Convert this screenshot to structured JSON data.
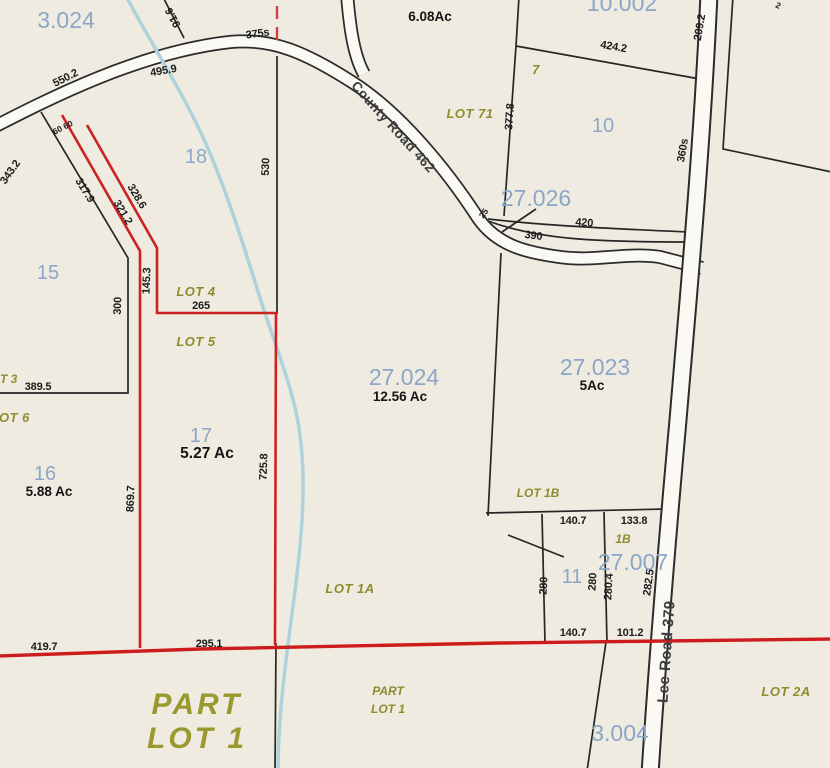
{
  "map_type": "parcel-plat-map",
  "colors": {
    "background": "#efebe0",
    "parcel_number_blue": "#8ba6c8",
    "lot_label_olive": "#8d8d2e",
    "highlight_red": "#cc1c1c",
    "stream_blue": "#aed2dc",
    "boundary_black": "#262626"
  },
  "roads": {
    "county": "County Road 462",
    "lee": "Lee Road 379"
  },
  "labels": {
    "p3_024": "3.024",
    "p10_002": "10.002",
    "p27_026": "27.026",
    "p27_024": "27.024",
    "p27_023": "27.023",
    "p27_007": "27.007",
    "p3_004": "3.004",
    "n7": "7",
    "n10": "10",
    "n11": "11",
    "n15": "15",
    "n16": "16",
    "n17": "17",
    "n18": "18",
    "lot71": "LOT 71",
    "lot4": "LOT 4",
    "lot5": "LOT 5",
    "lot1a": "LOT 1A",
    "lot1b": "LOT 1B",
    "lot1b_small": "1B",
    "lot2a": "LOT 2A",
    "lot3_part": "T 3",
    "lot6_part": "OT 6",
    "part_big_1": "PART",
    "part_big_2": "LOT 1",
    "part_small_1": "PART",
    "part_small_2": "LOT 1",
    "ac6_08": "6.08Ac",
    "ac12_56": "12.56 Ac",
    "ac5": "5Ac",
    "ac5_27": "5.27 Ac",
    "ac5_88": "5.88 Ac",
    "road_county": "County Road 462",
    "road_lee": "Lee Road 379",
    "d550_2": "550.2",
    "d495_9": "495.9",
    "d375s": "375s",
    "d91_6": "91.6",
    "d343_2": "343.2",
    "d317_9": "317.9",
    "d328_6": "328.6",
    "d321_2": "321.2",
    "d60_60": "60 60",
    "d145_3": "145.3",
    "d300": "300",
    "d265": "265",
    "d530": "530",
    "d389_5": "389.5",
    "d725_8": "725.8",
    "d869_7": "869.7",
    "d424_2": "424.2",
    "d209_2": "209.2",
    "d360s": "360s",
    "d377_8": "377.8",
    "d420": "420",
    "d390": "390",
    "d25": "25",
    "d2": "2",
    "d140_7_top": "140.7",
    "d133_8": "133.8",
    "d280_a": "280",
    "d280_b": "280",
    "d280_4": "280.4",
    "d282_5": "282.5",
    "d140_7_bot": "140.7",
    "d101_2": "101.2",
    "d419_7": "419.7",
    "d295_1": "295.1"
  }
}
